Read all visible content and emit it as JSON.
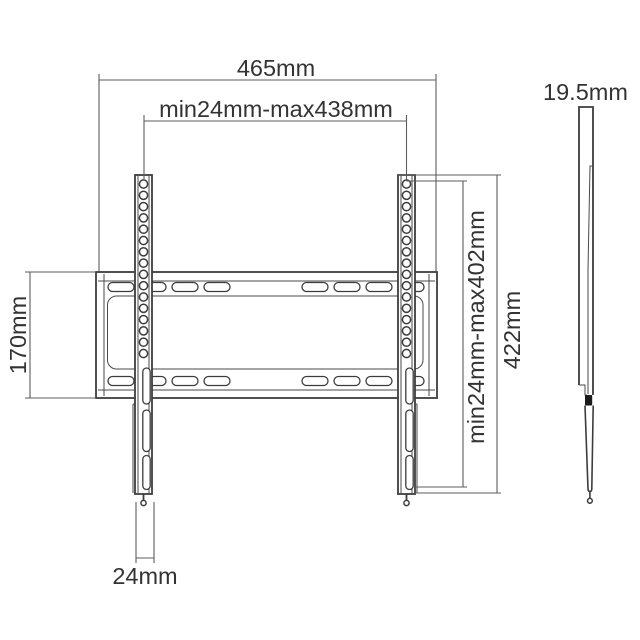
{
  "drawing": {
    "labels": {
      "total_width": "465mm",
      "vesa_width_range": "min24mm-max438mm",
      "plate_height": "170mm",
      "vesa_height_range": "min24mm-max402mm",
      "total_height": "422mm",
      "rail_width": "24mm",
      "profile_depth": "19.5mm"
    },
    "colors": {
      "outline": "#3c3c3c",
      "dimension_line": "#5d5d5d",
      "label_text": "#333333",
      "hook_fill": "#1a1a1a",
      "background": "#ffffff"
    }
  }
}
